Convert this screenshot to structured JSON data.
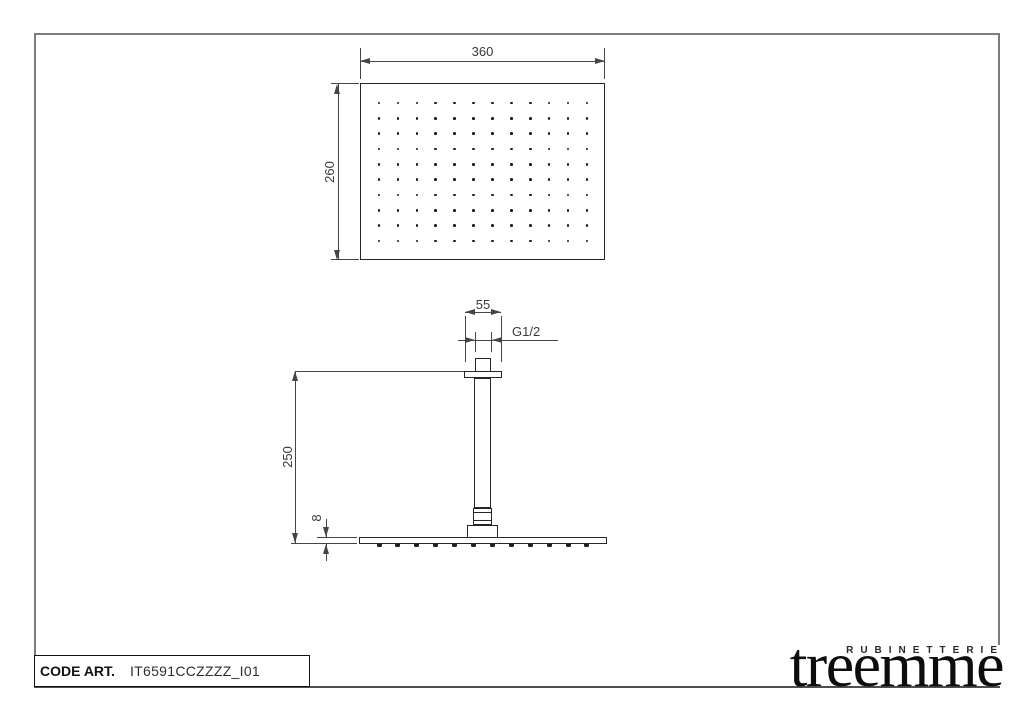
{
  "page": {
    "bg": "#ffffff",
    "frame_color": "#7c7c7c",
    "line_color": "#262626",
    "dim_color": "#454545",
    "ink_color": "#111111"
  },
  "title_block": {
    "code_label": "CODE ART.",
    "code_value": "IT6591CCZZZZ_I01"
  },
  "logo": {
    "tagline": "RUBINETTERIE",
    "brand": "treemme"
  },
  "drawing": {
    "top_view": {
      "width_mm": "360",
      "height_mm": "260",
      "nozzle_cols": 12,
      "nozzle_rows": 10
    },
    "side_view": {
      "flange_width_mm": "55",
      "thread_label": "G1/2",
      "height_mm": "250",
      "plate_thickness_mm": "8",
      "nozzle_count": 12
    }
  }
}
